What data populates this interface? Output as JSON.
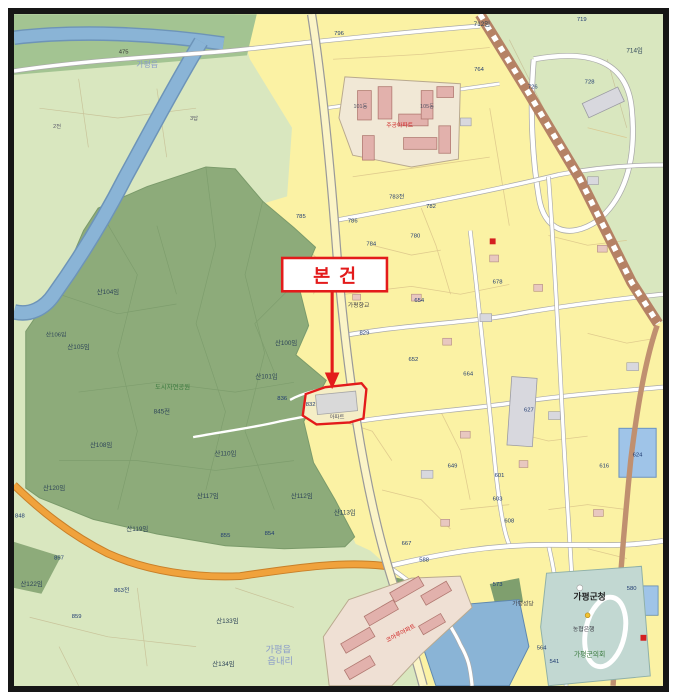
{
  "annotation": {
    "label": "본건",
    "box_color": "#e31b1b",
    "subject_parcel_number": "832",
    "subject_parcel_note": "아파트"
  },
  "colors": {
    "forest": "#8dab7a",
    "field_green": "#d9e7bf",
    "bank_green": "#a3c492",
    "urban_yellow": "#fbf2a4",
    "water": "#8ab4d6",
    "railway": "#b58265",
    "major_road": "#f0a23c",
    "minor_road": "#ffffff",
    "building_pink": "#e2b1ac",
    "building_gray": "#d8d8de",
    "civic_teal": "#c2d8d2",
    "annotation_red": "#e31b1b",
    "frame_black": "#161616"
  },
  "map": {
    "labels": [
      {
        "t": "가평읍",
        "x": 150,
        "y": 68,
        "c": "admin",
        "s": 8
      },
      {
        "t": "475",
        "x": 126,
        "y": 54,
        "c": "road"
      },
      {
        "t": "2전",
        "x": 58,
        "y": 130,
        "c": "tiny"
      },
      {
        "t": "3답",
        "x": 198,
        "y": 122,
        "c": "tiny"
      },
      {
        "t": "796",
        "x": 346,
        "y": 35,
        "c": "num"
      },
      {
        "t": "712임",
        "x": 492,
        "y": 26,
        "c": "forest"
      },
      {
        "t": "719",
        "x": 594,
        "y": 21,
        "c": "num"
      },
      {
        "t": "718",
        "x": 612,
        "y": 13,
        "c": "num"
      },
      {
        "t": "726",
        "x": 544,
        "y": 90,
        "c": "num"
      },
      {
        "t": "728",
        "x": 602,
        "y": 85,
        "c": "num"
      },
      {
        "t": "714임",
        "x": 648,
        "y": 53,
        "c": "forest"
      },
      {
        "t": "764",
        "x": 489,
        "y": 72,
        "c": "num"
      },
      {
        "t": "산104임",
        "x": 110,
        "y": 300,
        "c": "forest"
      },
      {
        "t": "산105임",
        "x": 80,
        "y": 356,
        "c": "forest"
      },
      {
        "t": "산106임",
        "x": 57,
        "y": 343,
        "c": "forest",
        "s": 6
      },
      {
        "t": "산100임",
        "x": 292,
        "y": 352,
        "c": "forest"
      },
      {
        "t": "산101임",
        "x": 272,
        "y": 386,
        "c": "forest"
      },
      {
        "t": "836",
        "x": 288,
        "y": 408,
        "c": "num"
      },
      {
        "t": "845전",
        "x": 165,
        "y": 422,
        "c": "forest"
      },
      {
        "t": "산108임",
        "x": 103,
        "y": 456,
        "c": "forest"
      },
      {
        "t": "산110임",
        "x": 230,
        "y": 465,
        "c": "forest"
      },
      {
        "t": "산112임",
        "x": 308,
        "y": 508,
        "c": "forest"
      },
      {
        "t": "산113임",
        "x": 352,
        "y": 525,
        "c": "forest"
      },
      {
        "t": "산120임",
        "x": 55,
        "y": 500,
        "c": "forest"
      },
      {
        "t": "산117임",
        "x": 212,
        "y": 508,
        "c": "forest"
      },
      {
        "t": "산119임",
        "x": 140,
        "y": 542,
        "c": "forest"
      },
      {
        "t": "산122임",
        "x": 32,
        "y": 598,
        "c": "forest"
      },
      {
        "t": "산133임",
        "x": 232,
        "y": 636,
        "c": "forest"
      },
      {
        "t": "산134임",
        "x": 228,
        "y": 680,
        "c": "forest"
      },
      {
        "t": "도시자연공원",
        "x": 176,
        "y": 397,
        "c": "green"
      },
      {
        "t": "855",
        "x": 230,
        "y": 548,
        "c": "num"
      },
      {
        "t": "854",
        "x": 275,
        "y": 546,
        "c": "num"
      },
      {
        "t": "848",
        "x": 20,
        "y": 528,
        "c": "num"
      },
      {
        "t": "857",
        "x": 60,
        "y": 571,
        "c": "num"
      },
      {
        "t": "859",
        "x": 78,
        "y": 631,
        "c": "num"
      },
      {
        "t": "863전",
        "x": 124,
        "y": 604,
        "c": "num"
      },
      {
        "t": "785",
        "x": 307,
        "y": 222,
        "c": "num"
      },
      {
        "t": "786",
        "x": 360,
        "y": 227,
        "c": "num"
      },
      {
        "t": "784",
        "x": 379,
        "y": 250,
        "c": "num"
      },
      {
        "t": "783전",
        "x": 405,
        "y": 202,
        "c": "num"
      },
      {
        "t": "782",
        "x": 440,
        "y": 212,
        "c": "num"
      },
      {
        "t": "780",
        "x": 424,
        "y": 242,
        "c": "num"
      },
      {
        "t": "829",
        "x": 372,
        "y": 341,
        "c": "num"
      },
      {
        "t": "654",
        "x": 428,
        "y": 308,
        "c": "num"
      },
      {
        "t": "652",
        "x": 422,
        "y": 368,
        "c": "num"
      },
      {
        "t": "678",
        "x": 508,
        "y": 289,
        "c": "num"
      },
      {
        "t": "664",
        "x": 478,
        "y": 383,
        "c": "num"
      },
      {
        "t": "649",
        "x": 462,
        "y": 477,
        "c": "num"
      },
      {
        "t": "601",
        "x": 510,
        "y": 487,
        "c": "num"
      },
      {
        "t": "603",
        "x": 508,
        "y": 511,
        "c": "num"
      },
      {
        "t": "608",
        "x": 520,
        "y": 533,
        "c": "num"
      },
      {
        "t": "616",
        "x": 617,
        "y": 477,
        "c": "num"
      },
      {
        "t": "627",
        "x": 540,
        "y": 420,
        "c": "num"
      },
      {
        "t": "624",
        "x": 651,
        "y": 466,
        "c": "num"
      },
      {
        "t": "667",
        "x": 415,
        "y": 556,
        "c": "num"
      },
      {
        "t": "588",
        "x": 433,
        "y": 573,
        "c": "num"
      },
      {
        "t": "573",
        "x": 508,
        "y": 598,
        "c": "num"
      },
      {
        "t": "564",
        "x": 553,
        "y": 663,
        "c": "num"
      },
      {
        "t": "541",
        "x": 566,
        "y": 677,
        "c": "num"
      },
      {
        "t": "580",
        "x": 645,
        "y": 602,
        "c": "num"
      },
      {
        "t": "가평향교",
        "x": 366,
        "y": 313,
        "c": "poi"
      },
      {
        "t": "가평성당",
        "x": 534,
        "y": 618,
        "c": "poi"
      },
      {
        "t": "농협은행",
        "x": 596,
        "y": 644,
        "c": "poi"
      },
      {
        "t": "가평군청",
        "x": 602,
        "y": 612,
        "c": "big"
      },
      {
        "t": "가평군의회",
        "x": 602,
        "y": 670,
        "c": "green",
        "s": 7
      },
      {
        "t": "주공아파트",
        "x": 408,
        "y": 129,
        "c": "red"
      },
      {
        "t": "101동",
        "x": 368,
        "y": 110,
        "c": "tiny"
      },
      {
        "t": "105동",
        "x": 436,
        "y": 110,
        "c": "tiny"
      },
      {
        "t": "코아루아파트",
        "x": 410,
        "y": 648,
        "c": "red",
        "r": -28
      },
      {
        "t": "가평읍",
        "x": 284,
        "y": 666,
        "c": "admin"
      },
      {
        "t": "읍내리",
        "x": 286,
        "y": 678,
        "c": "admin"
      },
      {
        "t": "832",
        "x": 317,
        "y": 414,
        "c": "num"
      },
      {
        "t": "아파트",
        "x": 344,
        "y": 427,
        "c": "tiny"
      }
    ]
  }
}
